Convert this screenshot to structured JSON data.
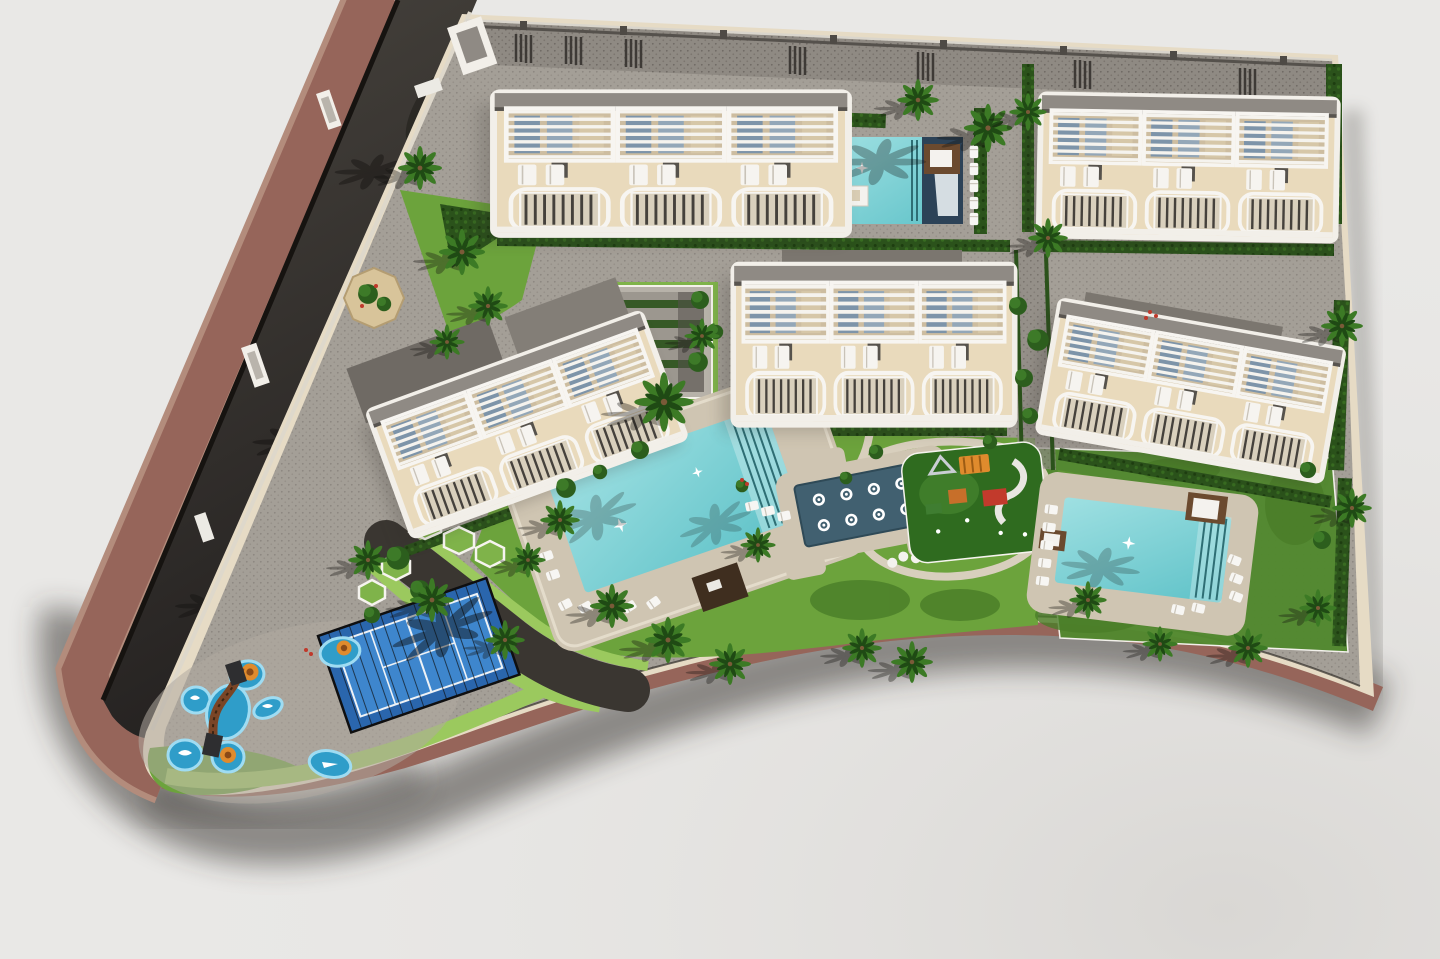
{
  "meta": {
    "title": "Aerial 3D render of residential development site plan",
    "view": "top-down aerial",
    "style": "architectural visualization"
  },
  "palette": {
    "background": "#e9e8e6",
    "background_corner": "#dcdad8",
    "road_asphalt": "#2e2b27",
    "road_light": "#49453f",
    "sidewalk_brown": "#96655a",
    "sidewalk_brown_light": "#b38c7c",
    "site_beige": "#e6dbc5",
    "paving_gray": "#a49f97",
    "paving_dot": "#8d8780",
    "paving_dark": "#8f8a83",
    "top_band_wall": "#55514c",
    "internal_drive": "#3a3631",
    "grass_bright": "#6ca33c",
    "grass_dark": "#4a7d28",
    "grass_light_strip": "#9bc95e",
    "grass_panel": "#52892f",
    "hedge_dark": "#2b521b",
    "building_beige": "#e9dabc",
    "building_white": "#f2efe9",
    "roof_gray": "#8f8a84",
    "roof_backdrop": "#7b766f",
    "window_blue": "#7d94a9",
    "deck_beige": "#cfc5b2",
    "pool_turquoise_light": "#9fe0e2",
    "pool_turquoise": "#5fc2c8",
    "pool_navy": "#2c4257",
    "spa_blue": "#416070",
    "court_blue": "#2a66ad",
    "court_blue_light": "#3e86cd",
    "splash_blue": "#2f9dc9",
    "splash_blue_light": "#9fdcf2",
    "play_orange": "#df8b2d",
    "play_red": "#c23a2c",
    "play_green": "#3f7d31",
    "wood_brown": "#6b4a2f",
    "wood_dark": "#3f2e1f",
    "ramp_gray": "#b7b2a9",
    "planter_tan": "#d8c49a",
    "shadow": "#2f2c28"
  },
  "scene": {
    "description": "Gated residential complex rendering with five townhouse blocks, three swimming pools, a hydromassage jet pool, padel court, kids splash water park, playground, palm trees and perimeter road",
    "buildings": [
      {
        "id": "building-1",
        "location": "top-left",
        "pergola_units": 3
      },
      {
        "id": "building-2",
        "location": "top-right",
        "pergola_units": 3
      },
      {
        "id": "building-3",
        "location": "middle-center",
        "pergola_units": 3
      },
      {
        "id": "building-4",
        "location": "middle-right",
        "pergola_units": 3
      },
      {
        "id": "building-5",
        "location": "middle-left",
        "pergola_units": 3
      }
    ],
    "amenities": [
      "swimming-pool-top",
      "swimming-pool-central",
      "hydromassage-jet-pool",
      "swimming-pool-right",
      "padel-court",
      "kids-splash-park",
      "children-playground",
      "parking-ramp"
    ],
    "vegetation": {
      "palm_trees": 27,
      "hedges": true,
      "lawns": true,
      "bushes": true
    },
    "roads": {
      "perimeter_road_side": "left",
      "sidewalk_color_name": "terracotta",
      "entrance_side": "west"
    }
  }
}
